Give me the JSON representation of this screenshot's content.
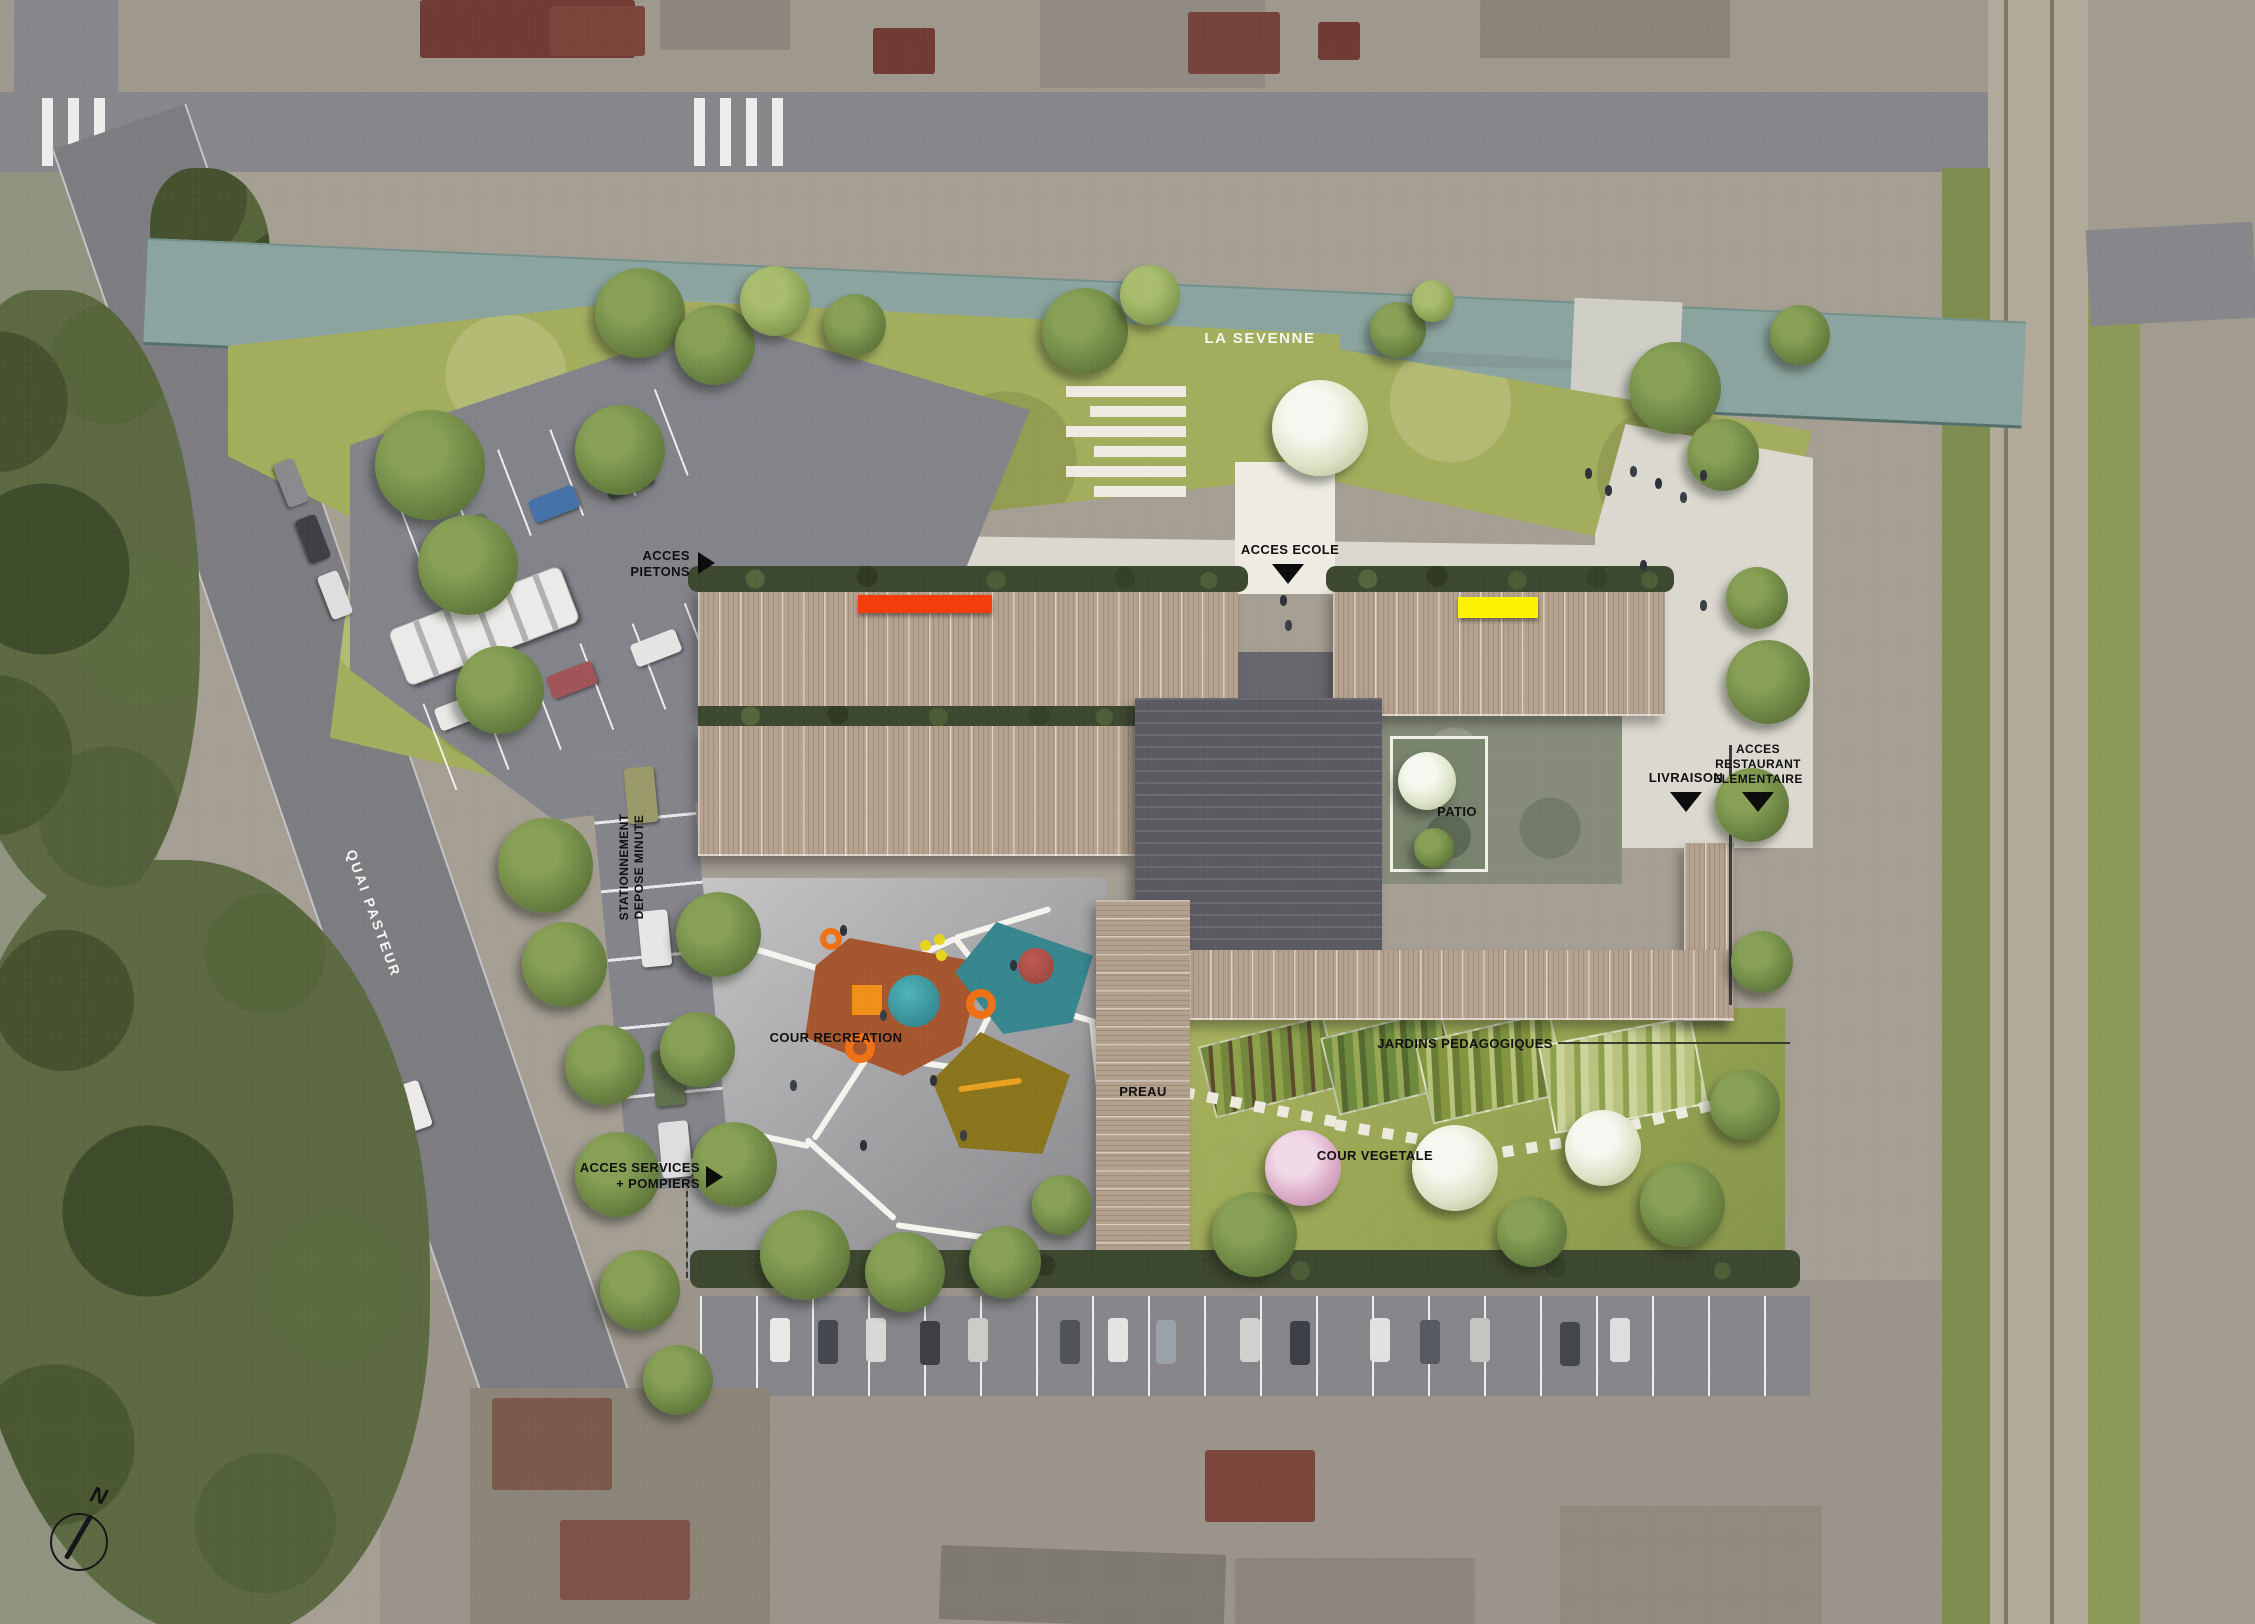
{
  "plan": {
    "type": "architectural site plan (school ground floor / landscape masterplan on aerial photo)",
    "compass_north": "N"
  },
  "labels": {
    "river": "LA SEVENNE",
    "street": "QUAI PASTEUR",
    "access_pedestrians": "ACCES\nPIETONS",
    "access_school": "ACCES ECOLE",
    "parking_dropoff": "STATIONNEMENT\nDEPOSE MINUTE",
    "playground": "COUR RECREATION",
    "access_services": "ACCES SERVICES\n+ POMPIERS",
    "covered_yard": "PREAU",
    "patio": "PATIO",
    "delivery": "LIVRAISON",
    "access_restaurant": "ACCES\nRESTAURANT\nELEMENTAIRE",
    "gardens": "JARDINS PEDAGOGIQUES",
    "green_yard": "COUR VEGETALE",
    "compass_north": "N"
  },
  "colors": {
    "accent_red_canopy": "#f53c0b",
    "accent_yellow_canopy": "#fdf200",
    "river_water": "#8ba49f",
    "wood_roof": "#b4a28e",
    "dark_roof": "#5a5a60",
    "lawn_green": "#a3ad5e",
    "play_orange": "#a5562f",
    "play_teal": "#37868d",
    "play_olive": "#8a751d",
    "ring_orange": "#ef7115"
  }
}
